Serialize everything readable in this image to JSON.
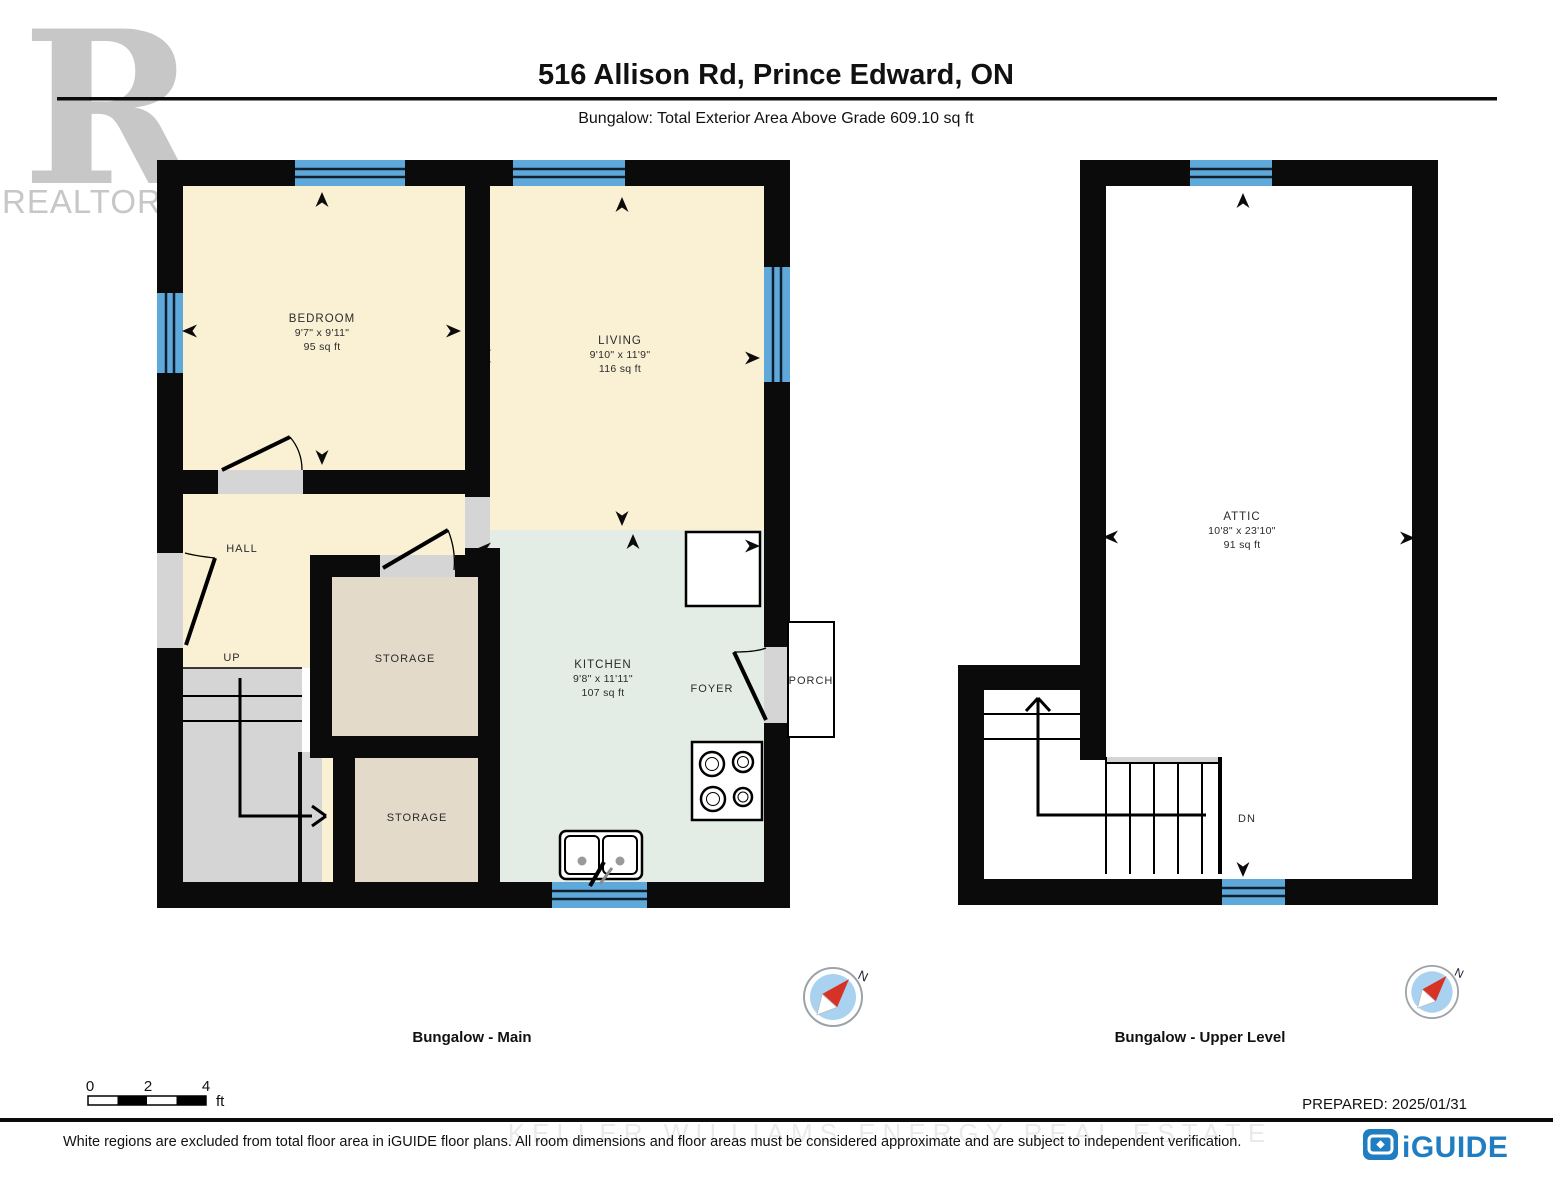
{
  "header": {
    "title": "516 Allison Rd, Prince Edward, ON",
    "subtitle": "Bungalow: Total Exterior Area Above Grade 609.10 sq ft"
  },
  "realtor_logo": {
    "letter": "R",
    "label": "REALTOR®"
  },
  "plans": {
    "main": {
      "label": "Bungalow - Main",
      "rooms": {
        "bedroom": {
          "name": "BEDROOM",
          "dims": "9'7\" x 9'11\"",
          "area": "95 sq ft"
        },
        "living": {
          "name": "LIVING",
          "dims": "9'10\" x 11'9\"",
          "area": "116 sq ft"
        },
        "kitchen": {
          "name": "KITCHEN",
          "dims": "9'8\" x 11'11\"",
          "area": "107 sq ft"
        },
        "hall": {
          "name": "HALL"
        },
        "storage1": {
          "name": "STORAGE"
        },
        "storage2": {
          "name": "STORAGE"
        },
        "foyer": {
          "name": "FOYER"
        },
        "porch": {
          "name": "PORCH"
        },
        "up_label": "UP"
      }
    },
    "upper": {
      "label": "Bungalow - Upper Level",
      "rooms": {
        "attic": {
          "name": "ATTIC",
          "dims": "10'8\" x 23'10\"",
          "area": "91 sq ft"
        },
        "dn_label": "DN"
      }
    }
  },
  "compass": {
    "north": "N"
  },
  "scale_bar": {
    "t0": "0",
    "t2": "2",
    "t4": "4",
    "unit": "ft"
  },
  "prepared": "PREPARED: 2025/01/31",
  "footer": {
    "disclaimer": "White regions are excluded from total floor area in iGUIDE floor plans. All room dimensions and floor areas must be considered approximate and are subject to independent verification.",
    "watermark": "KELLER WILLIAMS ENERGY REAL ESTATE"
  },
  "iguide_logo": {
    "label": "iGUIDE"
  },
  "colors": {
    "wall": "#0b0b0b",
    "window_blue": "#5FA9DA",
    "room_cream": "#FAF0D4",
    "kitchen_green": "#E3EDE6",
    "storage_tan": "#E3DACA",
    "stairs_gray": "#D5D5D5",
    "iguide_blue": "#1F7DC1",
    "compass_red": "#D63226",
    "realtor_gray": "#C7C7C7"
  }
}
